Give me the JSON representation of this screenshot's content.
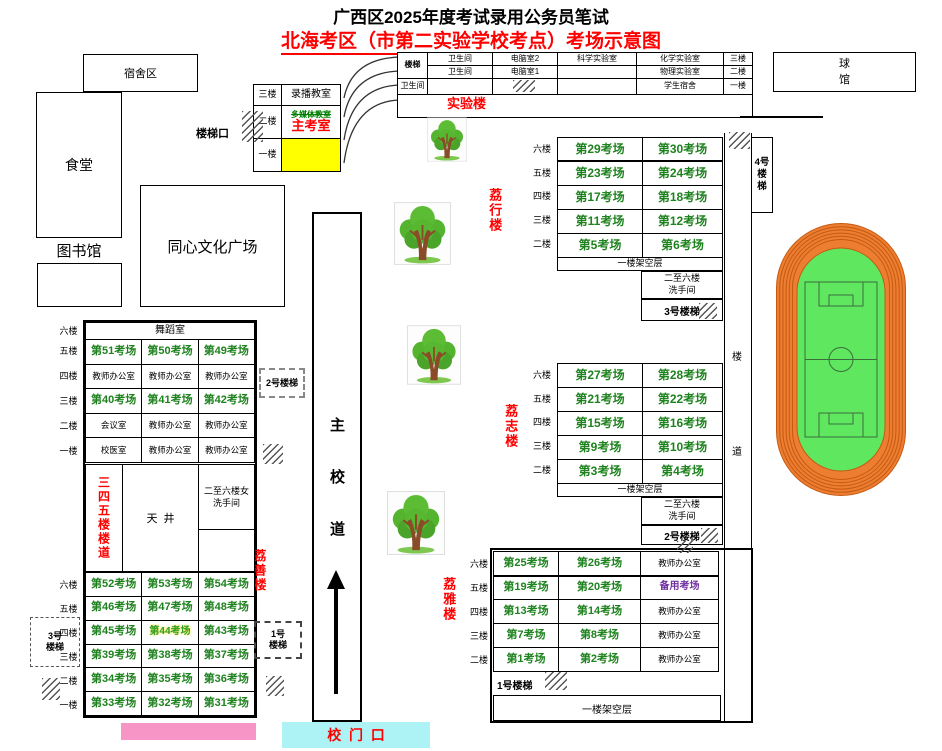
{
  "colors": {
    "exam_green": "#1e821e",
    "red": "#ff0000",
    "purple": "#7030a0",
    "yellow": "#ffff00",
    "pink": "#f895c7",
    "cyan": "#adf2f5",
    "track_orange": "#ed7d31",
    "track_lane_line": "#c55a11",
    "field_green": "#5fe75f"
  },
  "header": {
    "title": "广西区2025年度考试录用公务员笔试",
    "subtitle_underline": "北海考区（市第二实验学校考点）",
    "subtitle_rest": "考场示意图"
  },
  "campus": {
    "dorm": "宿舍区",
    "canteen": "食堂",
    "library": "图书馆",
    "plaza": "同心文化广场",
    "ball_hall": "球\n馆",
    "stair_entrance": "楼梯口",
    "road": [
      "主",
      "校",
      "道"
    ],
    "gate": "校  门  口",
    "corridor": [
      "楼",
      "道"
    ],
    "stair4": "4号\n楼\n梯"
  },
  "admin_building": {
    "floors": [
      "三楼",
      "二楼",
      "一楼"
    ],
    "recording_room": "录播教室",
    "multimedia_room": "多媒体教室",
    "chief_exam_office": "主考室"
  },
  "lab_building": {
    "label": "实验楼",
    "stair": "楼梯",
    "toilet": "卫生间",
    "computer2": "电脑室2",
    "computer1": "电脑室1",
    "science": "科学实验室",
    "chemistry": "化学实验室",
    "physics": "物理实验室",
    "student_dorm": "学生宿舍",
    "floors": [
      "三楼",
      "二楼",
      "一楼"
    ]
  },
  "lixing": {
    "label": "荔行楼",
    "floors": [
      "六楼",
      "五楼",
      "四楼",
      "三楼",
      "二楼"
    ],
    "rooms": [
      [
        "第29考场",
        "第30考场"
      ],
      [
        "第23考场",
        "第24考场"
      ],
      [
        "第17考场",
        "第18考场"
      ],
      [
        "第11考场",
        "第12考场"
      ],
      [
        "第5考场",
        "第6考场"
      ]
    ],
    "ground": "一楼架空层",
    "washroom": "二至六楼\n洗手间",
    "stair": "3号楼梯"
  },
  "lizhi": {
    "label": "荔志楼",
    "floors": [
      "六楼",
      "五楼",
      "四楼",
      "三楼",
      "二楼"
    ],
    "rooms": [
      [
        "第27考场",
        "第28考场"
      ],
      [
        "第21考场",
        "第22考场"
      ],
      [
        "第15考场",
        "第16考场"
      ],
      [
        "第9考场",
        "第10考场"
      ],
      [
        "第3考场",
        "第4考场"
      ]
    ],
    "ground": "一楼架空层",
    "washroom": "二至六楼\n洗手间",
    "stair": "2号楼梯"
  },
  "liya": {
    "label": "荔雅楼",
    "floors": [
      "六楼",
      "五楼",
      "四楼",
      "三楼",
      "二楼"
    ],
    "rows": [
      [
        "第25考场",
        "第26考场",
        "教师办公室"
      ],
      [
        "第19考场",
        "第20考场",
        "备用考场"
      ],
      [
        "第13考场",
        "第14考场",
        "教师办公室"
      ],
      [
        "第7考场",
        "第8考场",
        "教师办公室"
      ],
      [
        "第1考场",
        "第2考场",
        "教师办公室"
      ]
    ],
    "stair": "1号楼梯",
    "ground": "一楼架空层"
  },
  "lishan": {
    "label": "荔善楼",
    "upper_floors": [
      "六楼",
      "五楼",
      "四楼",
      "三楼",
      "二楼",
      "一楼"
    ],
    "dance_room": "舞蹈室",
    "upper_rows": [
      [
        "第51考场",
        "第50考场",
        "第49考场"
      ],
      [
        "教师办公室",
        "教师办公室",
        "教师办公室"
      ],
      [
        "第40考场",
        "第41考场",
        "第42考场"
      ],
      [
        "会议室",
        "教师办公室",
        "教师办公室"
      ],
      [
        "校医室",
        "教师办公室",
        "教师办公室"
      ]
    ],
    "corridor345": "三四五楼楼道",
    "courtyard": "天  井",
    "women_washroom": "二至六楼女\n洗手间",
    "lower_floors": [
      "六楼",
      "五楼",
      "四楼",
      "三楼",
      "二楼",
      "一楼"
    ],
    "lower_rows": [
      [
        "第52考场",
        "第53考场",
        "第54考场"
      ],
      [
        "第46考场",
        "第47考场",
        "第48考场"
      ],
      [
        "第45考场",
        "第44考场",
        "第43考场"
      ],
      [
        "第39考场",
        "第38考场",
        "第37考场"
      ],
      [
        "第34考场",
        "第35考场",
        "第36考场"
      ],
      [
        "第33考场",
        "第32考场",
        "第31考场"
      ]
    ],
    "stair2": "2号楼梯",
    "stair1": "1号\n楼梯",
    "stair3": "3号\n楼梯"
  }
}
